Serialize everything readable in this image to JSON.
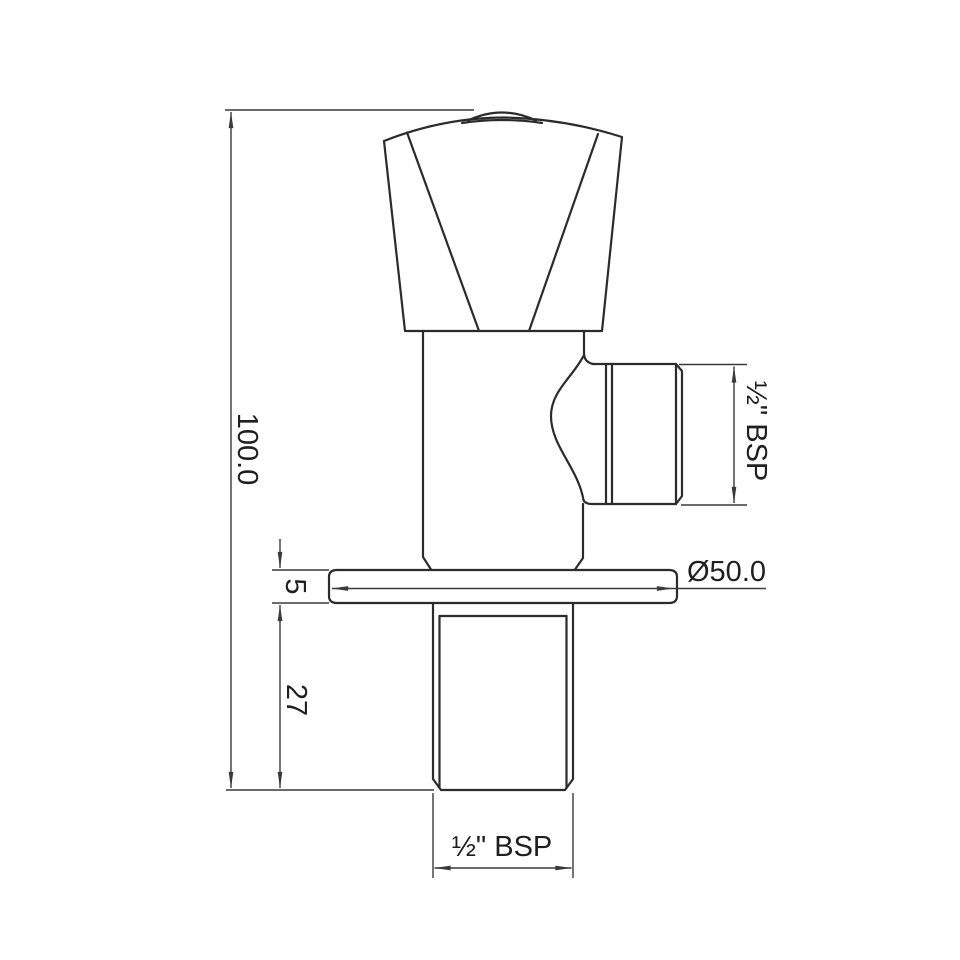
{
  "drawing": {
    "part": "angle-valve-front-elevation",
    "colors": {
      "line": "#2b2b2b",
      "dim": "#3a3a3a",
      "text": "#1f1f1f",
      "background": "#ffffff"
    },
    "dimensions": {
      "overall_height": "100.0",
      "flange_thickness": "5",
      "inlet_thread_length": "27",
      "flange_diameter": "Ø50.0",
      "outlet_thread": "½\" BSP",
      "inlet_thread": "½\" BSP"
    }
  }
}
